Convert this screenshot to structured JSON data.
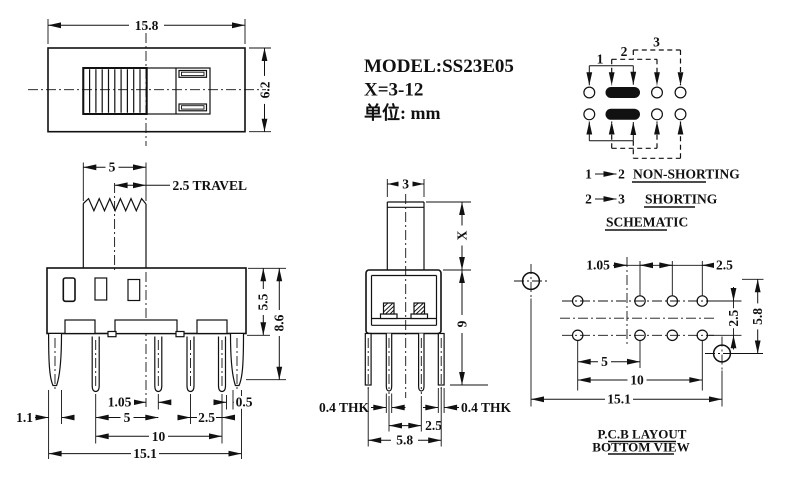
{
  "title_block": {
    "model": "MODEL:SS23E05",
    "x_range": "X=3-12",
    "unit": "单位: mm"
  },
  "top_view": {
    "dim_width": "15.8",
    "dim_height": "6.2"
  },
  "front_view": {
    "dim_knob_width": "5",
    "dim_travel": "2.5 TRAVEL",
    "dim_upper_height": "5.5",
    "dim_total_height": "8.6",
    "dim_leg_width": "1.1",
    "dim_center_offset": "1.05",
    "dim_pin_pitch": "5",
    "dim_pin_pitch_small": "2.5",
    "dim_edge_gap": "0.5",
    "dim_pin_span": "10",
    "dim_overall_width": "15.1"
  },
  "side_view": {
    "dim_stem_width": "3",
    "dim_stem_height": "X",
    "dim_body_height": "9",
    "dim_thk_left": "0.4 THK",
    "dim_thk_right": "0.4 THK",
    "dim_pin_gap": "2.5",
    "dim_overall_width": "5.8"
  },
  "schematic": {
    "pin1": "1",
    "pin2": "2",
    "pin3": "3",
    "note1_from": "1",
    "note1_to": "2",
    "note1_label": "NON-SHORTING",
    "note2_from": "2",
    "note2_to": "3",
    "note2_label": "SHORTING",
    "caption": "SCHEMATIC"
  },
  "pcb_layout": {
    "dim_center_offset": "1.05",
    "dim_pitch_small": "2.5",
    "dim_row_gap": "2.5",
    "dim_hole_span_v": "5.8",
    "dim_pitch": "5",
    "dim_span": "10",
    "dim_overall": "15.1",
    "caption_line1": "P.C.B LAYOUT",
    "caption_line2": "BOTTOM VIEW"
  }
}
